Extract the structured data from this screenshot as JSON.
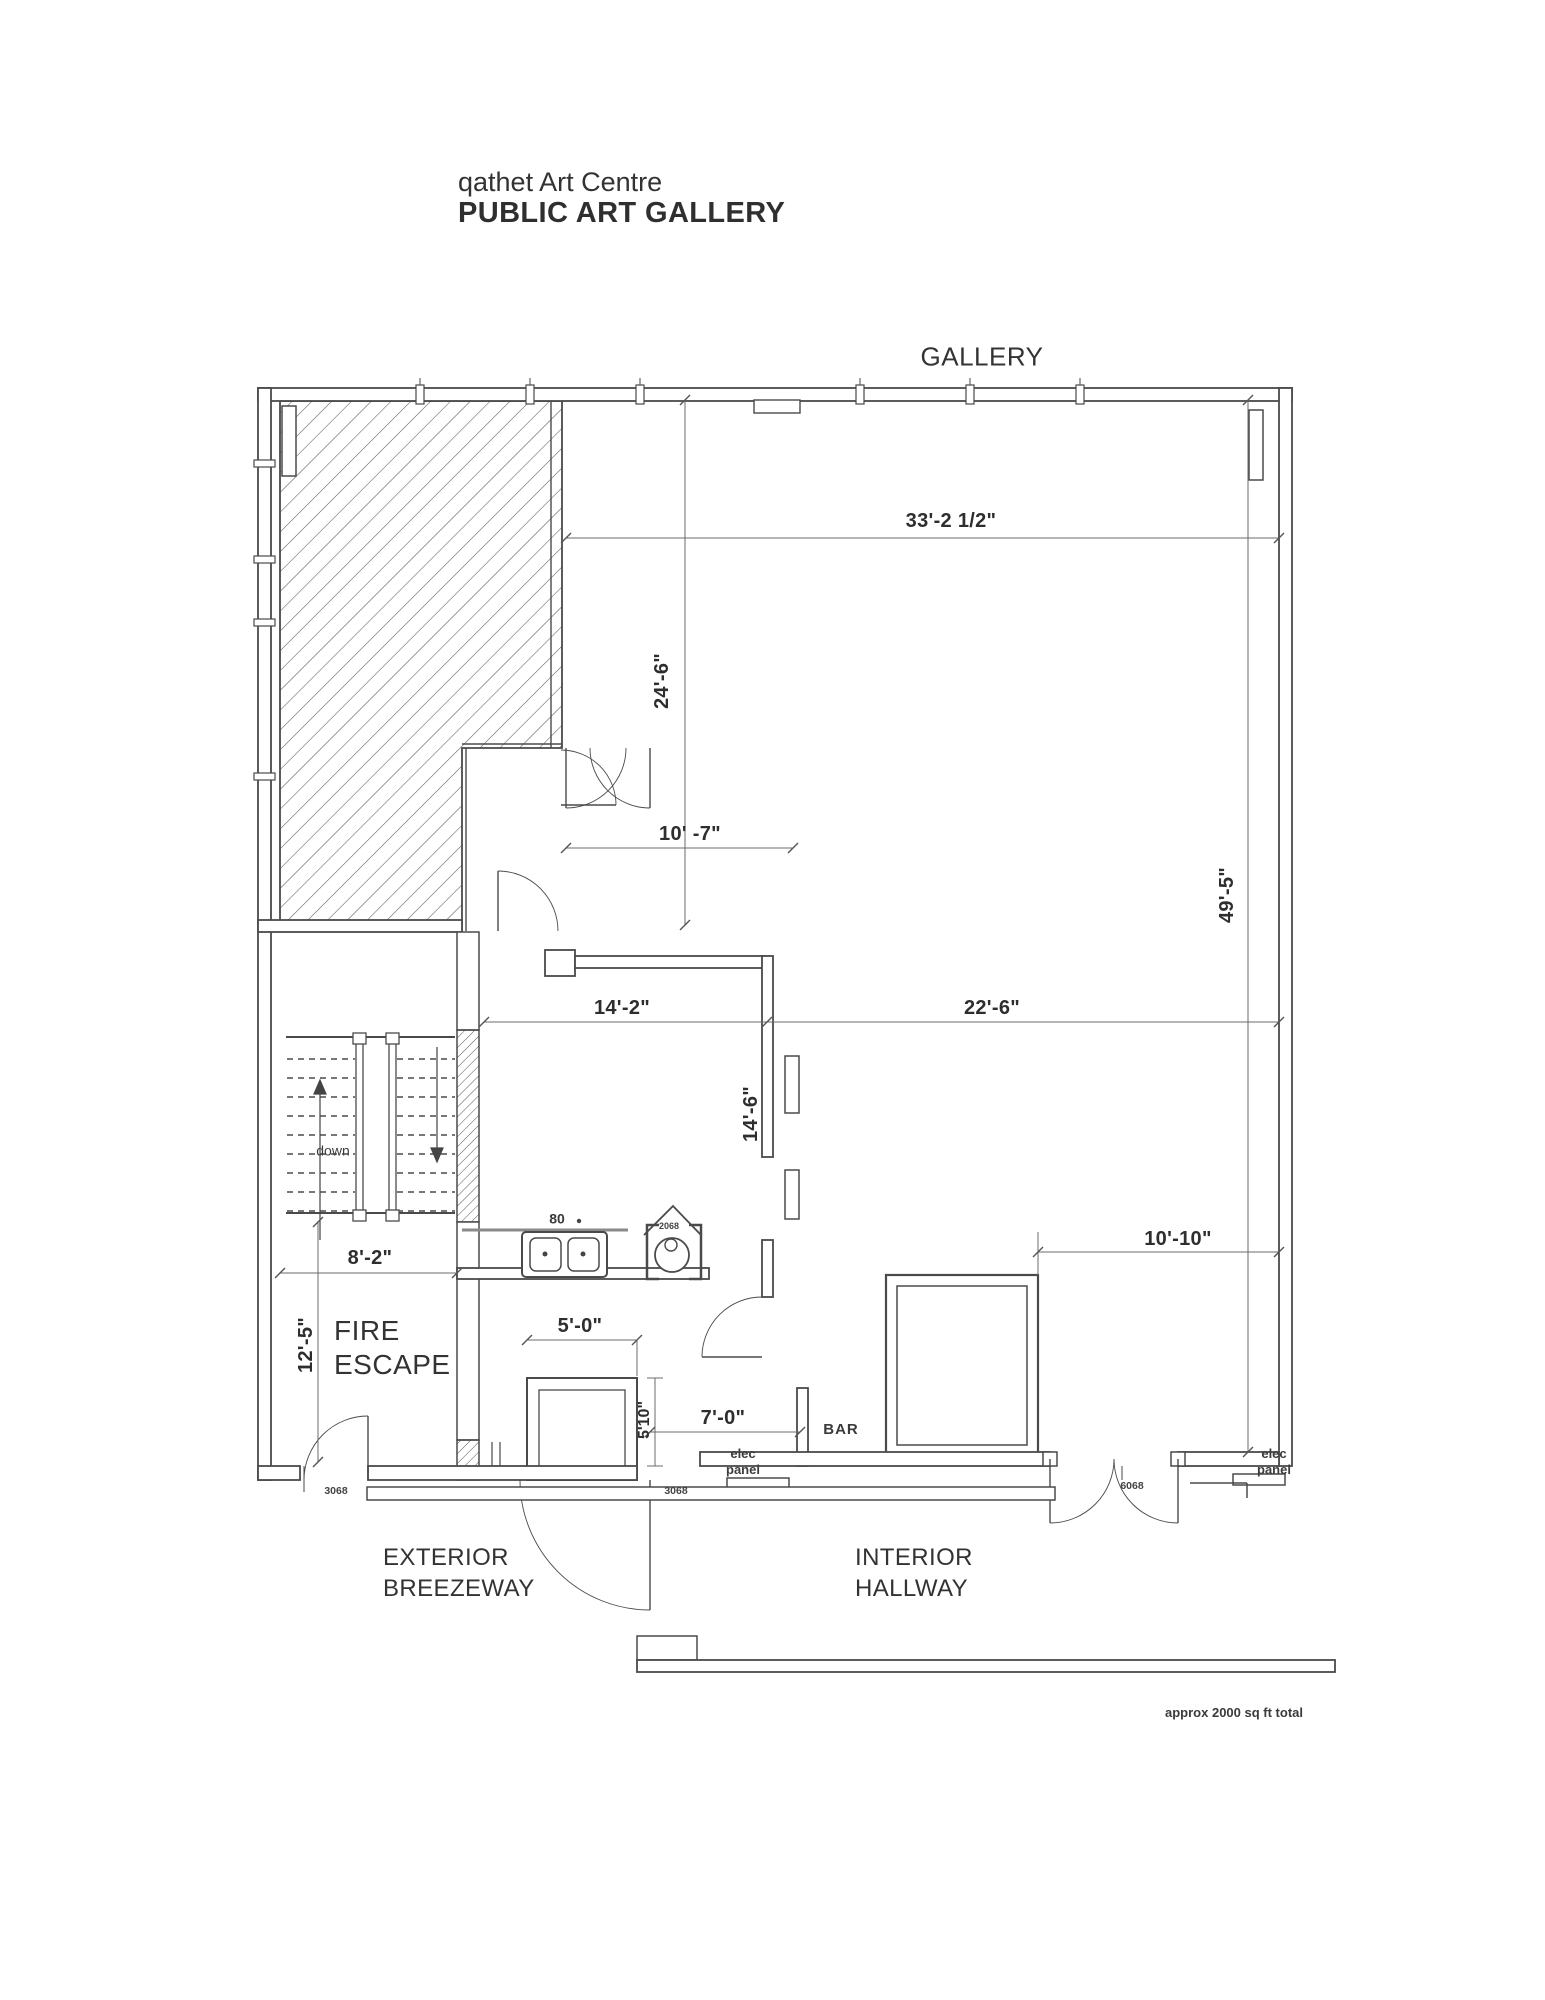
{
  "title": {
    "line1": "qathet Art Centre",
    "line2": "PUBLIC ART GALLERY"
  },
  "rooms": {
    "gallery": "GALLERY",
    "fire_escape": {
      "line1": "FIRE",
      "line2": "ESCAPE"
    },
    "bar": "BAR",
    "exterior_breezeway": {
      "line1": "EXTERIOR",
      "line2": "BREEZEWAY"
    },
    "interior_hallway": {
      "line1": "INTERIOR",
      "line2": "HALLWAY"
    }
  },
  "dimensions": {
    "gallery_width": "33'-2 1/2\"",
    "gallery_upper_depth": "24'-6\"",
    "vestibule_width": "10' -7\"",
    "gallery_depth": "49'-5\"",
    "kitchen_width": "14'-2\"",
    "gallery_lower_width": "22'-6\"",
    "kitchen_depth": "14'-6\"",
    "fire_escape_width": "8'-2\"",
    "fire_escape_depth": "12'-5\"",
    "lower_right_width": "10'-10\"",
    "closet_width": "5'-0\"",
    "closet_depth": "5'10\"",
    "bar_passage_width": "7'-0\""
  },
  "annotations": {
    "stair_direction": "down",
    "sink_code": "80",
    "wc_door_code": "2068",
    "fire_escape_door_code": "3068",
    "breezeway_door_code": "3068",
    "hallway_door_code": "6068",
    "elec_panel_left": {
      "line1": "elec",
      "line2": "panel"
    },
    "elec_panel_right": {
      "line1": "elec",
      "line2": "panel"
    },
    "area_note": "approx 2000 sq ft total"
  },
  "colors": {
    "wall": "#4a4a4a",
    "dim_line": "#6b6b6b",
    "text": "#3a3a3a"
  }
}
